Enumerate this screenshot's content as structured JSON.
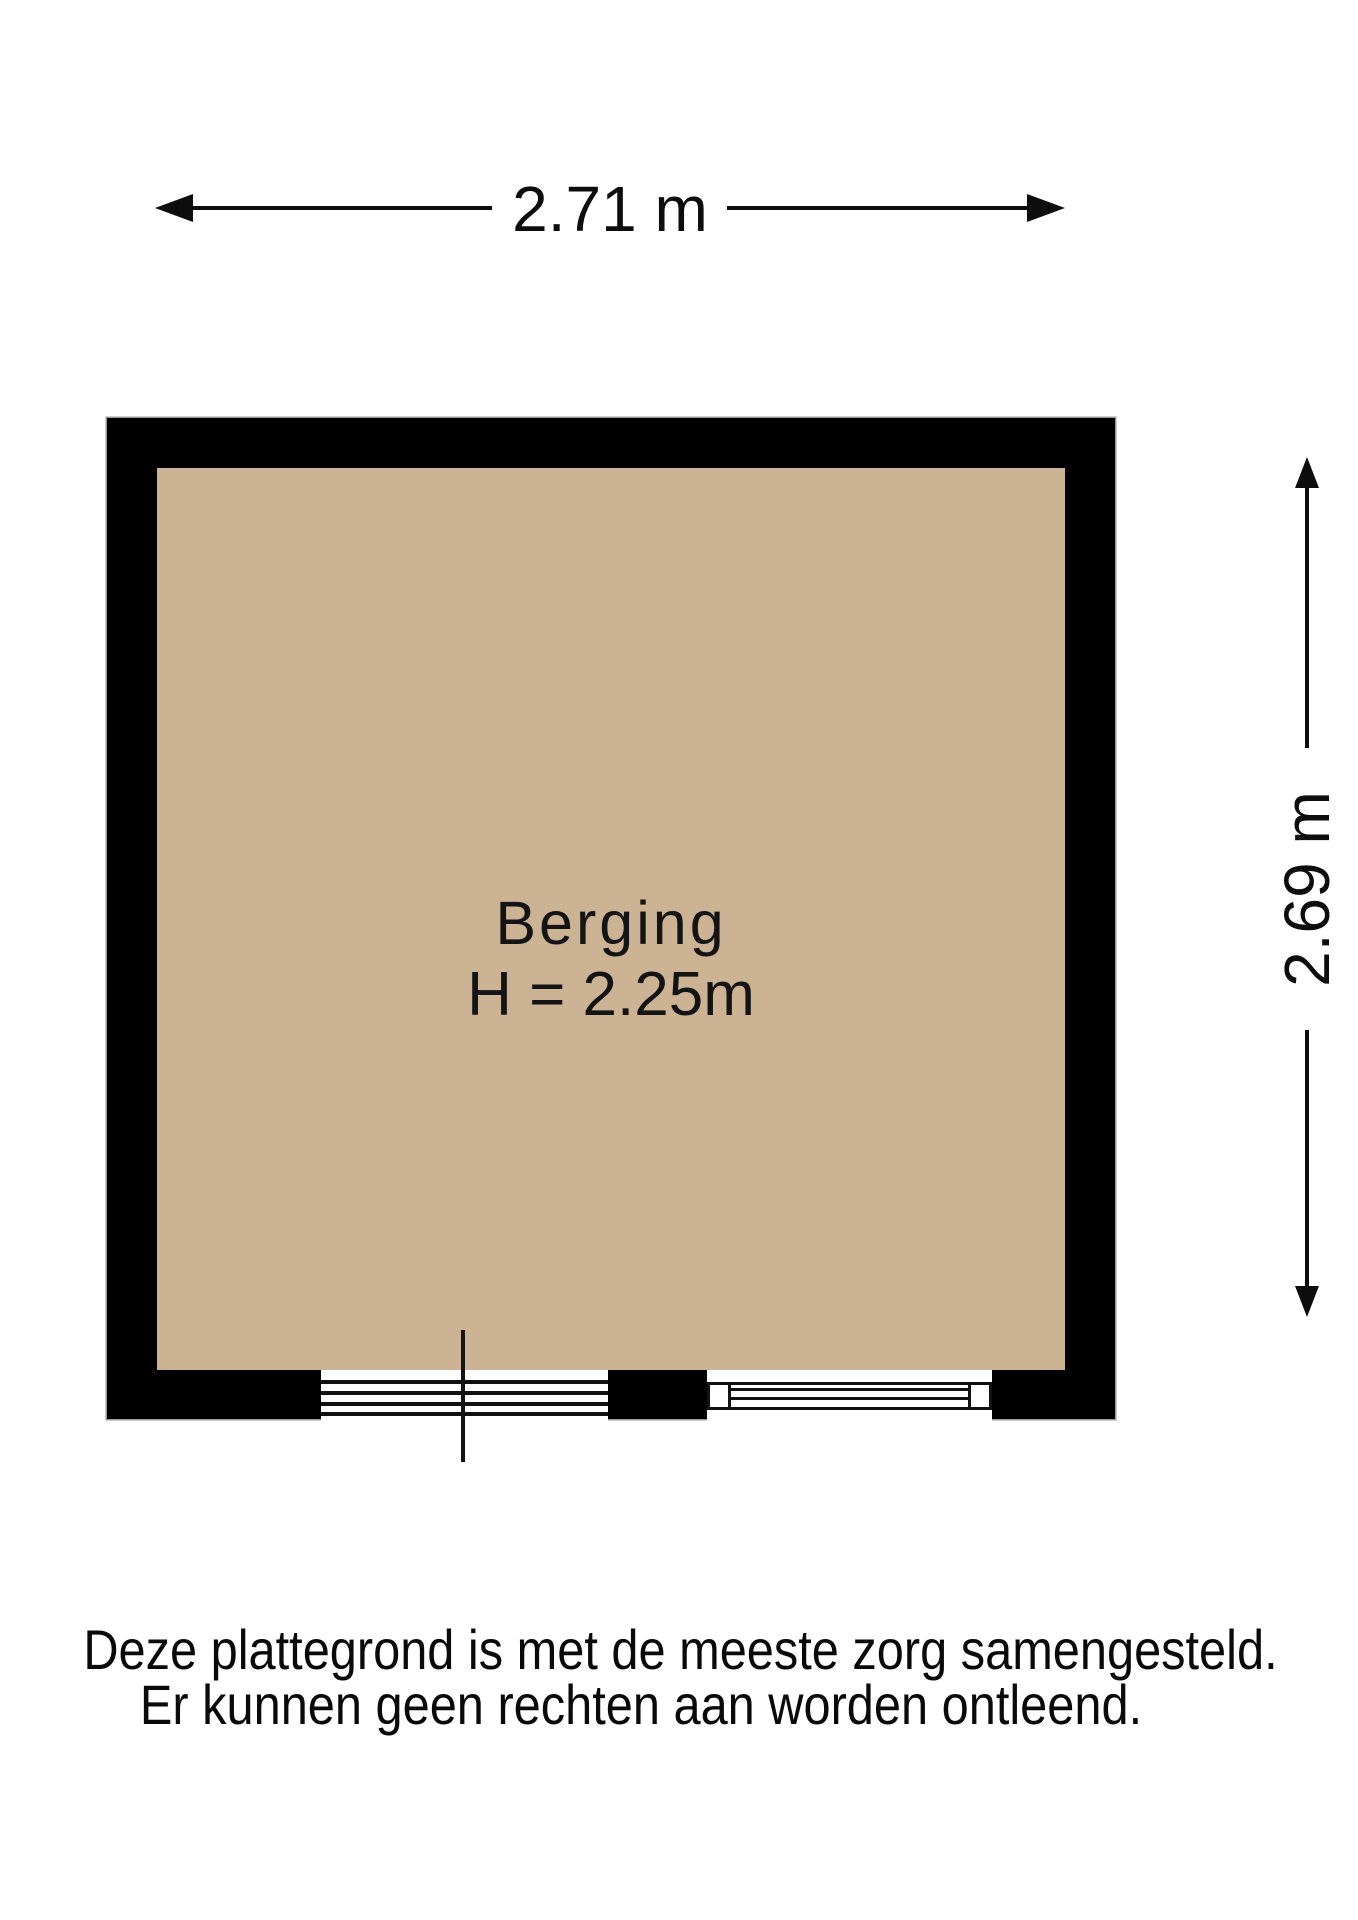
{
  "floorplan": {
    "dimension_width": {
      "label": "2.71 m"
    },
    "dimension_height": {
      "label": "2.69 m"
    },
    "room": {
      "name": "Berging",
      "ceiling_height_label": "H = 2.25m"
    },
    "colors": {
      "floor": "#cbb394",
      "wall": "#000000"
    },
    "disclaimer": {
      "line1": "Deze plattegrond is met de meeste zorg samengesteld.",
      "line2": "Er kunnen geen rechten aan worden ontleend."
    }
  }
}
